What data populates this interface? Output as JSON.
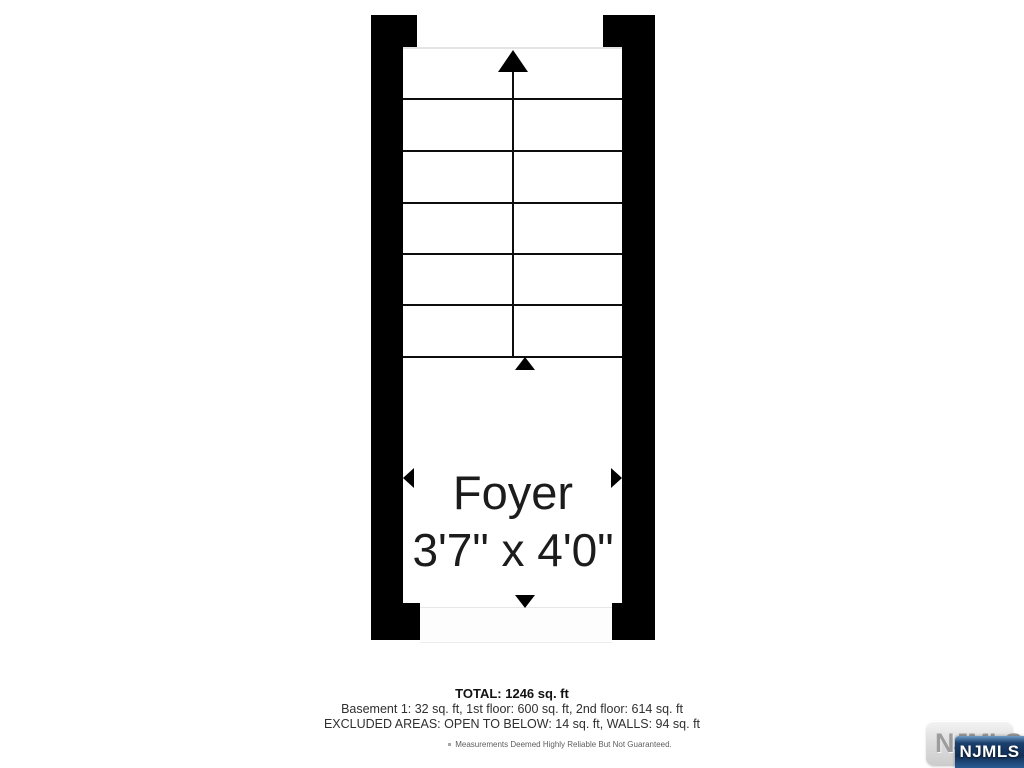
{
  "floor_plan": {
    "room_name": "Foyer",
    "room_dimensions": "3'7\" x 4'0\"",
    "stairs": {
      "steps": 6,
      "direction": "up"
    }
  },
  "summary": {
    "total": "TOTAL: 1246 sq. ft",
    "floor_breakdown": "Basement 1: 32 sq. ft, 1st floor: 600 sq. ft, 2nd floor: 614 sq. ft",
    "excluded_areas": "EXCLUDED AREAS: OPEN TO BELOW: 14 sq. ft, WALLS: 94 sq. ft",
    "disclaimer": "Measurements Deemed Highly Reliable But Not Guaranteed."
  },
  "branding": {
    "watermark_text": "NJMLS",
    "logo_text": "NJMLS"
  },
  "colors": {
    "wall": "#000000",
    "stair_line": "#0d0d0d",
    "room_text": "#1c1c1c",
    "summary_text": "#2f2f2f",
    "disclaimer_text": "#5e5e5e",
    "logo_blue_dark": "#132f56",
    "logo_blue_light": "#2a5c95",
    "watermark_gray": "#9d9d9d"
  }
}
